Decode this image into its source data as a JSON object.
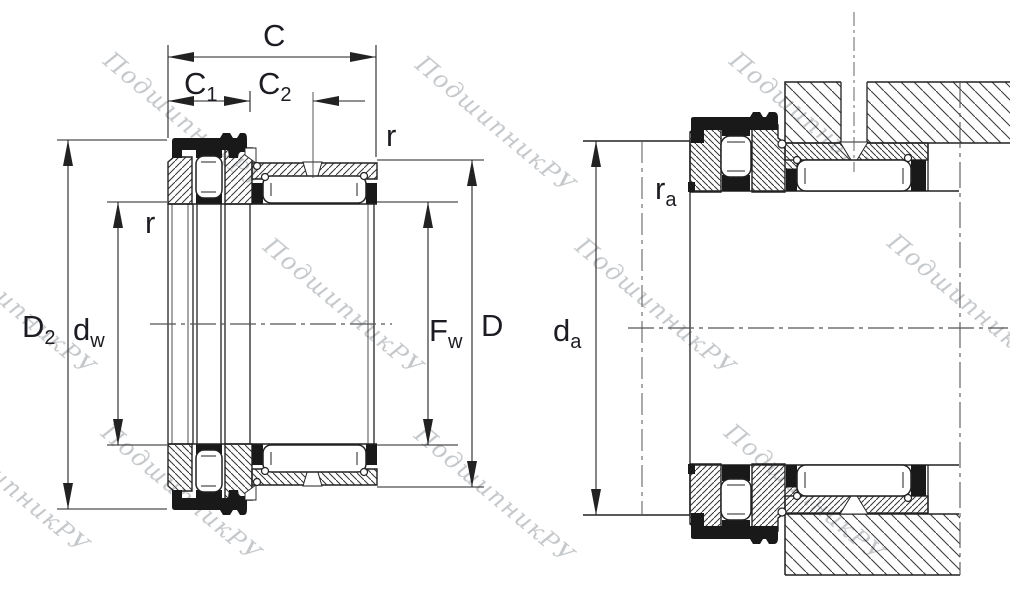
{
  "drawing": {
    "type": "bearing technical drawing",
    "description": "Cross-section of combined needle roller / axial ball bearing: left view free bearing with dimensions, right view mounted on shaft with housing and abutment dimensions"
  },
  "labels": {
    "c": "C",
    "c1": {
      "base": "C",
      "sub": "1"
    },
    "c2": {
      "base": "C",
      "sub": "2"
    },
    "r_outer": "r",
    "r_bore": "r",
    "d2": {
      "base": "D",
      "sub": "2"
    },
    "dw": {
      "base": "d",
      "sub": "w"
    },
    "fw": {
      "base": "F",
      "sub": "w"
    },
    "d": "D",
    "da": {
      "base": "d",
      "sub": "a"
    },
    "ra": {
      "base": "r",
      "sub": "a"
    }
  },
  "watermark": {
    "text": "ПодшипникРУ",
    "color": "#c6c9cc"
  },
  "colors": {
    "line": "#222222",
    "centerline": "#555555",
    "black_fill": "#191919",
    "background": "#ffffff"
  }
}
